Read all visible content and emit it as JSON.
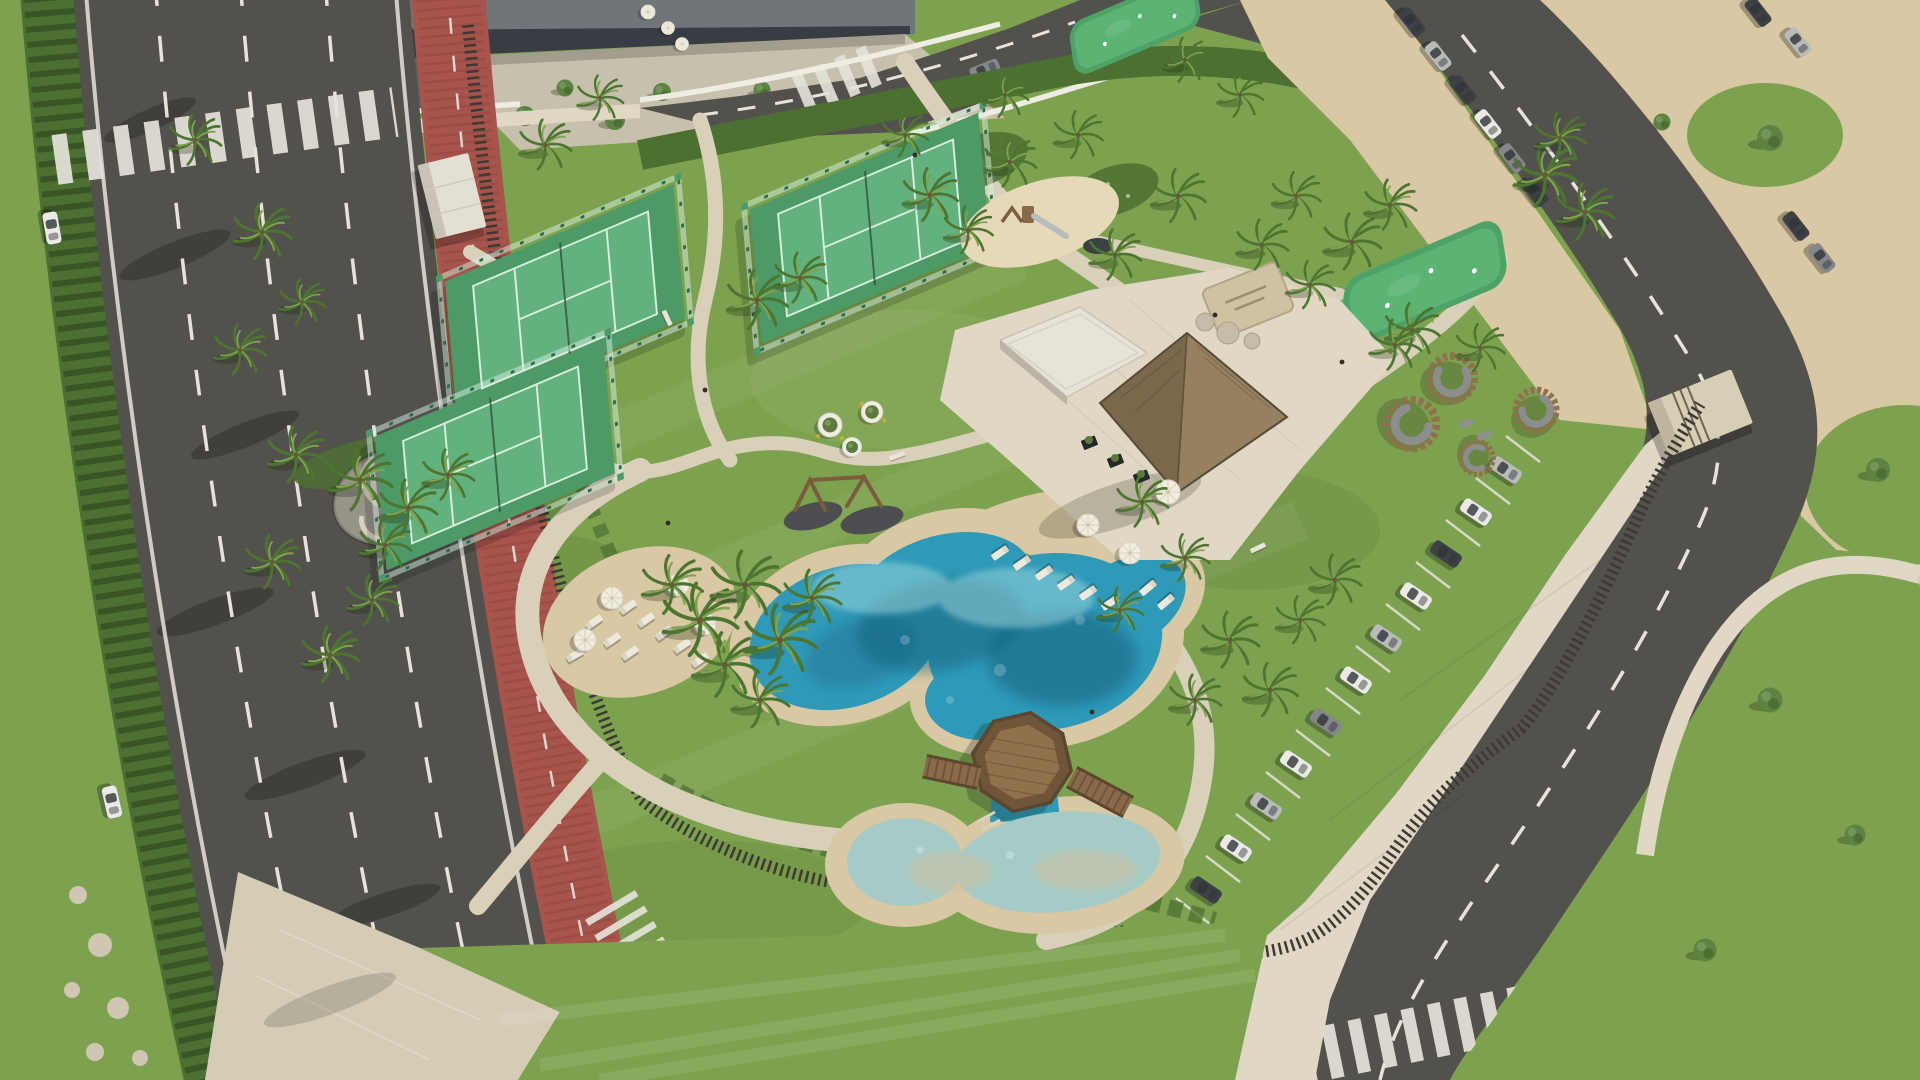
{
  "scene": {
    "title": "Aerial 3D render - coastal resort amenity gardens",
    "description": "Aerial architectural rendering of a beachfront resort amenity area: lagoon-style swimming pools with sandy edges, octagonal timber deck, thatched-roof clubhouse with white pavilion, three fenced padel courts, putting greens, children's playground, palm gardens, circular timber lounge pods, a boulevard with a red bike lane on the left and angled visitor parking on the right beside a sand beach area",
    "areas": {
      "boulevard": {
        "label": "boulevard",
        "lanes": 3,
        "bike_lane": "red cycle lane",
        "pedestrian_crossings": 2,
        "moving_cars": 3
      },
      "padel_courts": {
        "label": "padel courts",
        "count": 3
      },
      "putting_greens": {
        "label": "putting greens",
        "count": 2
      },
      "playground": {
        "label": "children playground with slide"
      },
      "main_pool": {
        "label": "lagoon-style main pool with sandy beach edge"
      },
      "kids_pool": {
        "label": "shallow kids pool"
      },
      "deck": {
        "label": "octagonal wooden deck with two bridges"
      },
      "clubhouse": {
        "label": "thatched-roof clubhouse"
      },
      "pavilion": {
        "label": "white flat-roof pavilion"
      },
      "lounge_pods": {
        "label": "circular timber lounge pods",
        "count": 4
      },
      "sun_loungers": {
        "count": 17
      },
      "parasols": {
        "count": 7
      },
      "gravel_lounge": {
        "label": "gravel seating circle with curved stone benches"
      },
      "fitness_frames": {
        "label": "timber swing / fitness frames",
        "count": 2
      },
      "perimeter_fence": {
        "label": "dark timber slat perimeter fence"
      },
      "beach": {
        "label": "sand beach expanse top right"
      },
      "parking_right": {
        "label": "angled parking row",
        "parked_cars": 11,
        "maneuvering_suv": 1
      },
      "street_parking_top_right": {
        "parked_cars": 10
      },
      "parking_top_left": {
        "parked_cars": 8,
        "red_vehicles": 2
      },
      "office_building": {
        "label": "modern grey building with glazed facade"
      },
      "gatehouse": {
        "label": "beige entrance gatehouse"
      }
    }
  },
  "colors": {
    "grass": "#7da24f",
    "grassDark": "#66893f",
    "lawnLight": "#8fae5e",
    "hedge": "#4c7032",
    "road": "#53514c",
    "roadLight": "#605e58",
    "laneMark": "#e6e3da",
    "bike": "#a6544c",
    "bikeDark": "#8e423b",
    "path": "#d9d0ba",
    "pathLight": "#e0d8c4",
    "plaza": "#d5ccb6",
    "sand": "#dccfae",
    "beach": "#d9c8a4",
    "pool": "#2f9ab8",
    "poolDeep": "#15607e",
    "poolPale": "#a6cbc7",
    "courtTurf": "#4d9a66",
    "courtTurfLight": "#63b17c",
    "courtLine": "#d9eee0",
    "courtFence": "#2c6b4b",
    "thatch": "#95815f",
    "thatchDark": "#7a684c",
    "whiteRoof": "#e7e3d8",
    "wallWhite": "#efece2",
    "wood": "#91714b",
    "woodDark": "#6f5639",
    "fenceSlat": "#3c3a33",
    "gravel": "#99948a",
    "carWhite": "#eceae6",
    "carSilver": "#b9bbb8",
    "carGray": "#84878a",
    "carDark": "#3d4145",
    "carRed": "#b23a34",
    "palmDark": "#4c7531",
    "palmLight": "#7fa24e",
    "treeGreen": "#5c8340"
  }
}
